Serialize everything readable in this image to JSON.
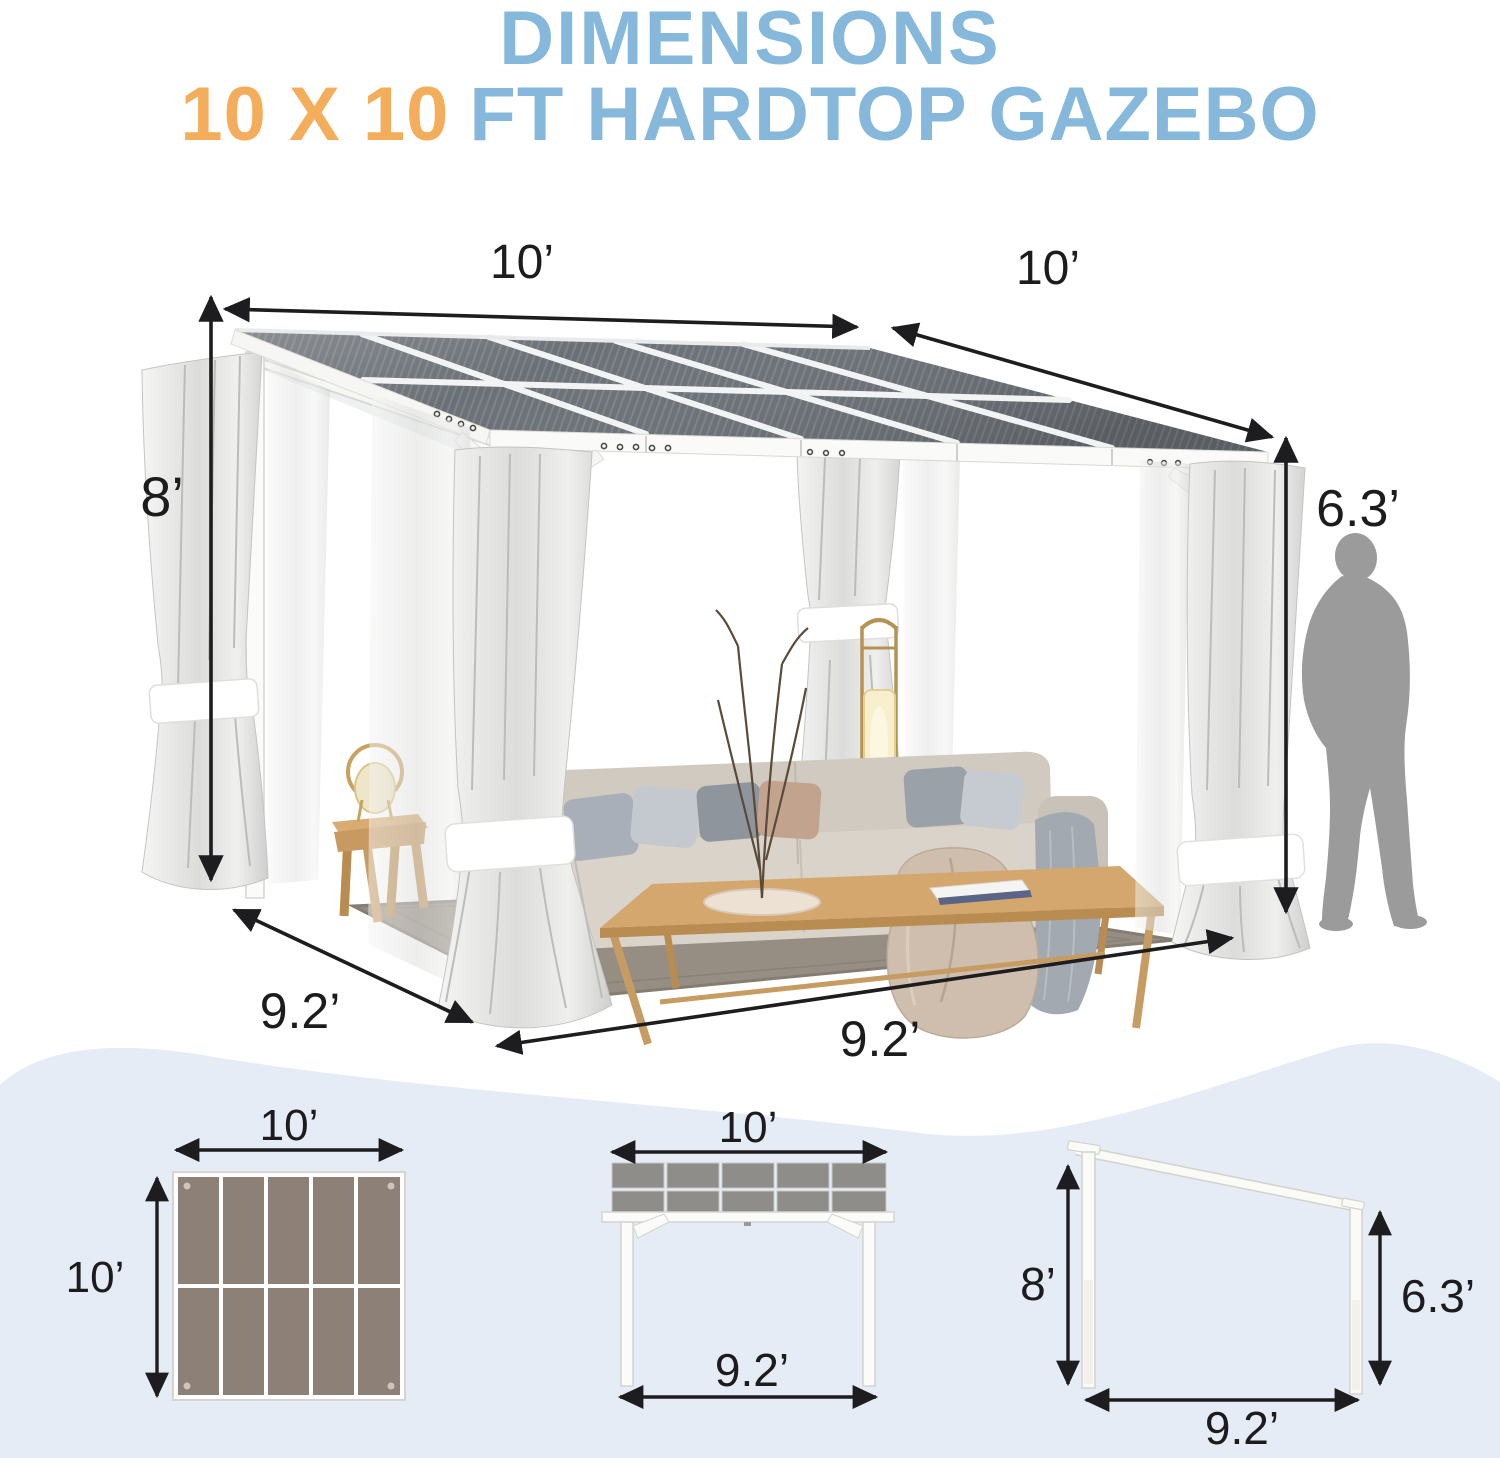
{
  "title": {
    "line1": "DIMENSIONS",
    "line2_highlight": "10 X 10",
    "line2_rest": "FT HARDTOP GAZEBO"
  },
  "main_view": {
    "roof_width_label": "10’",
    "roof_depth_label": "10’",
    "back_height_label": "8’",
    "front_height_label": "6.3’",
    "side_base_label": "9.2’",
    "front_base_label": "9.2’"
  },
  "top_view": {
    "width_label": "10’",
    "depth_label": "10’"
  },
  "front_view": {
    "width_label": "10’",
    "base_label": "9.2’"
  },
  "side_view": {
    "back_height_label": "8’",
    "front_height_label": "6.3’",
    "base_label": "9.2’"
  },
  "colors": {
    "title_blue": "#85b8db",
    "title_orange": "#f4ad5b",
    "dimension_text": "#1c1c1e",
    "wave_background": "#e6ecf5",
    "roof_panel": "#6b7076",
    "plan_panel": "#8d8177",
    "silhouette_gray": "#9b9b9b"
  }
}
